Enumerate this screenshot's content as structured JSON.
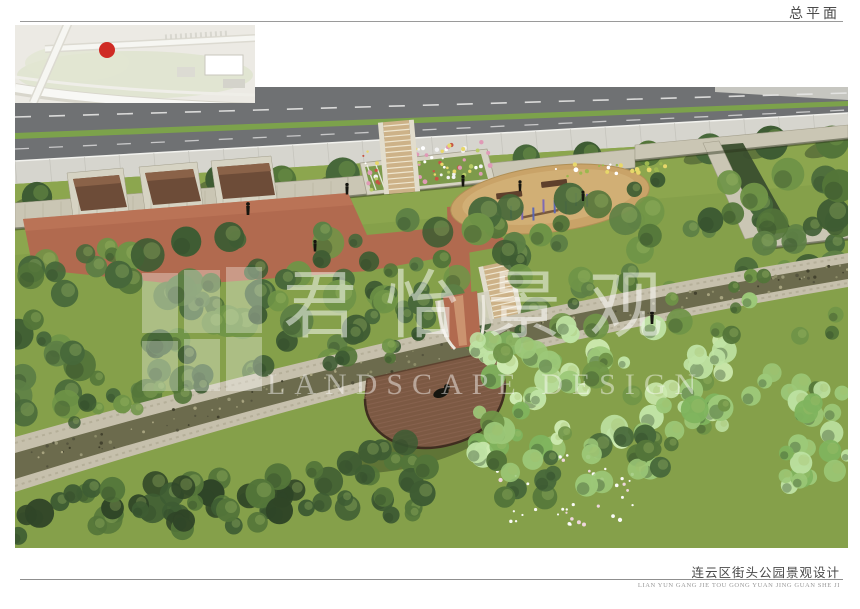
{
  "header": {
    "title": "总平面"
  },
  "watermark": {
    "cn": "君怡景观",
    "en": "LANDSCAPE DESIGN"
  },
  "footer": {
    "title": "连云区街头公园景观设计",
    "pinyin": "LIAN YUN GANG JIE TOU GONG YUAN JING GUAN SHE JI"
  },
  "colors": {
    "road": "#6f7173",
    "sidewalk": "#d6d5ce",
    "median": "#7ca24b",
    "lawn": "#85a04a",
    "lawn_light": "#8ca64e",
    "stone": "#cac6b4",
    "stone_dark": "#a39f8c",
    "alcove": "#d6d3c3",
    "brick": "#b16a4f",
    "brick_light": "#d09a74",
    "wood": "#7c5943",
    "wood_dark": "#5e4330",
    "sand": "#c9a368",
    "canal": "#6c6b4d",
    "canal_stone": "#c6c0ac",
    "tree_dark": "#3e5c33",
    "tree_mid": "#537539",
    "tree_light": "#6f9447",
    "shrub_light": "#9cc878",
    "shrub_mint": "#bfe3a4",
    "flower_white": "#ffffff",
    "flower_yellow": "#e8d86a",
    "flower_pink": "#df9ab6",
    "purple": "#7a66b8",
    "figure": "#15150f",
    "marker_red": "#cf2b24"
  }
}
